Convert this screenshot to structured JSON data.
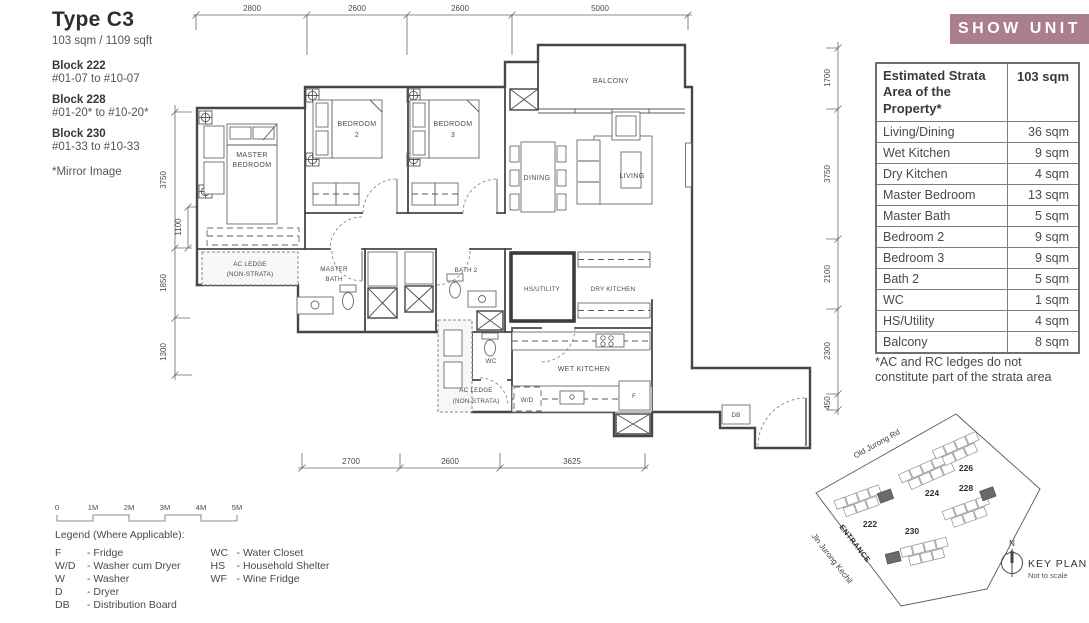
{
  "unit_info": {
    "type_title": "Type C3",
    "area": "103 sqm / 1109 sqft",
    "blocks": [
      {
        "name": "Block 222",
        "levels": "#01-07 to #10-07"
      },
      {
        "name": "Block 228",
        "levels": "#01-20* to #10-20*"
      },
      {
        "name": "Block 230",
        "levels": "#01-33 to #10-33"
      }
    ],
    "note": "*Mirror Image"
  },
  "show_unit": {
    "label": "SHOW UNIT",
    "bg_color": "#a87f8b"
  },
  "strata_table": {
    "header_label": "Estimated Strata Area of the Property*",
    "header_value": "103 sqm",
    "rows": [
      {
        "label": "Living/Dining",
        "value": "36 sqm"
      },
      {
        "label": "Wet Kitchen",
        "value": "9 sqm"
      },
      {
        "label": "Dry Kitchen",
        "value": "4 sqm"
      },
      {
        "label": "Master Bedroom",
        "value": "13 sqm"
      },
      {
        "label": "Master Bath",
        "value": "5 sqm"
      },
      {
        "label": "Bedroom 2",
        "value": "9 sqm"
      },
      {
        "label": "Bedroom 3",
        "value": "9 sqm"
      },
      {
        "label": "Bath 2",
        "value": "5 sqm"
      },
      {
        "label": "WC",
        "value": "1 sqm"
      },
      {
        "label": "HS/Utility",
        "value": "4 sqm"
      },
      {
        "label": "Balcony",
        "value": "8 sqm"
      }
    ],
    "footnote": "*AC and RC ledges do not constitute part of the strata area"
  },
  "floorplan": {
    "labels": {
      "master_bedroom": [
        "MASTER",
        "BEDROOM"
      ],
      "bedroom2": [
        "BEDROOM",
        "2"
      ],
      "bedroom3": [
        "BEDROOM",
        "3"
      ],
      "balcony": "BALCONY",
      "dining": "DINING",
      "living": "LIVING",
      "master_bath": [
        "MASTER",
        "BATH"
      ],
      "bath2": "BATH 2",
      "hs_utility": "HS/UTILITY",
      "dry_kitchen": "DRY KITCHEN",
      "wet_kitchen": "WET KITCHEN",
      "wc": "WC",
      "ac_ledge_left": [
        "AC LEDGE",
        "(NON-STRATA)"
      ],
      "ac_ledge_bottom": [
        "AC LEDGE",
        "(NON-STRATA)"
      ],
      "wd": "W/D",
      "fridge": "F",
      "db": "DB"
    },
    "dims": {
      "top": [
        "2800",
        "2600",
        "2600",
        "5000"
      ],
      "left": [
        "3750",
        "1100",
        "1850",
        "1300"
      ],
      "right": [
        "1700",
        "3750",
        "2100",
        "2300",
        "450"
      ],
      "bottom": [
        "2700",
        "2600",
        "3625"
      ]
    }
  },
  "scale_bar": {
    "ticks": [
      "0",
      "1M",
      "2M",
      "3M",
      "4M",
      "5M"
    ]
  },
  "legend": {
    "title": "Legend (Where Applicable):",
    "column1": [
      {
        "abbr": "F",
        "desc": "- Fridge"
      },
      {
        "abbr": "W/D",
        "desc": "- Washer cum Dryer"
      },
      {
        "abbr": "W",
        "desc": "- Washer"
      },
      {
        "abbr": "D",
        "desc": "- Dryer"
      },
      {
        "abbr": "DB",
        "desc": "- Distribution Board"
      }
    ],
    "column2": [
      {
        "abbr": "WC",
        "desc": "- Water Closet"
      },
      {
        "abbr": "HS",
        "desc": "- Household Shelter"
      },
      {
        "abbr": "WF",
        "desc": "- Wine Fridge"
      }
    ]
  },
  "key_plan": {
    "road_top": "Old Jurong Rd",
    "road_left": "Jln Jurong Kechil",
    "entrance": "ENTRANCE",
    "clusters": [
      "222",
      "224",
      "226",
      "228",
      "230"
    ],
    "north": "N",
    "title": "KEY PLAN",
    "note": "Not to scale"
  }
}
